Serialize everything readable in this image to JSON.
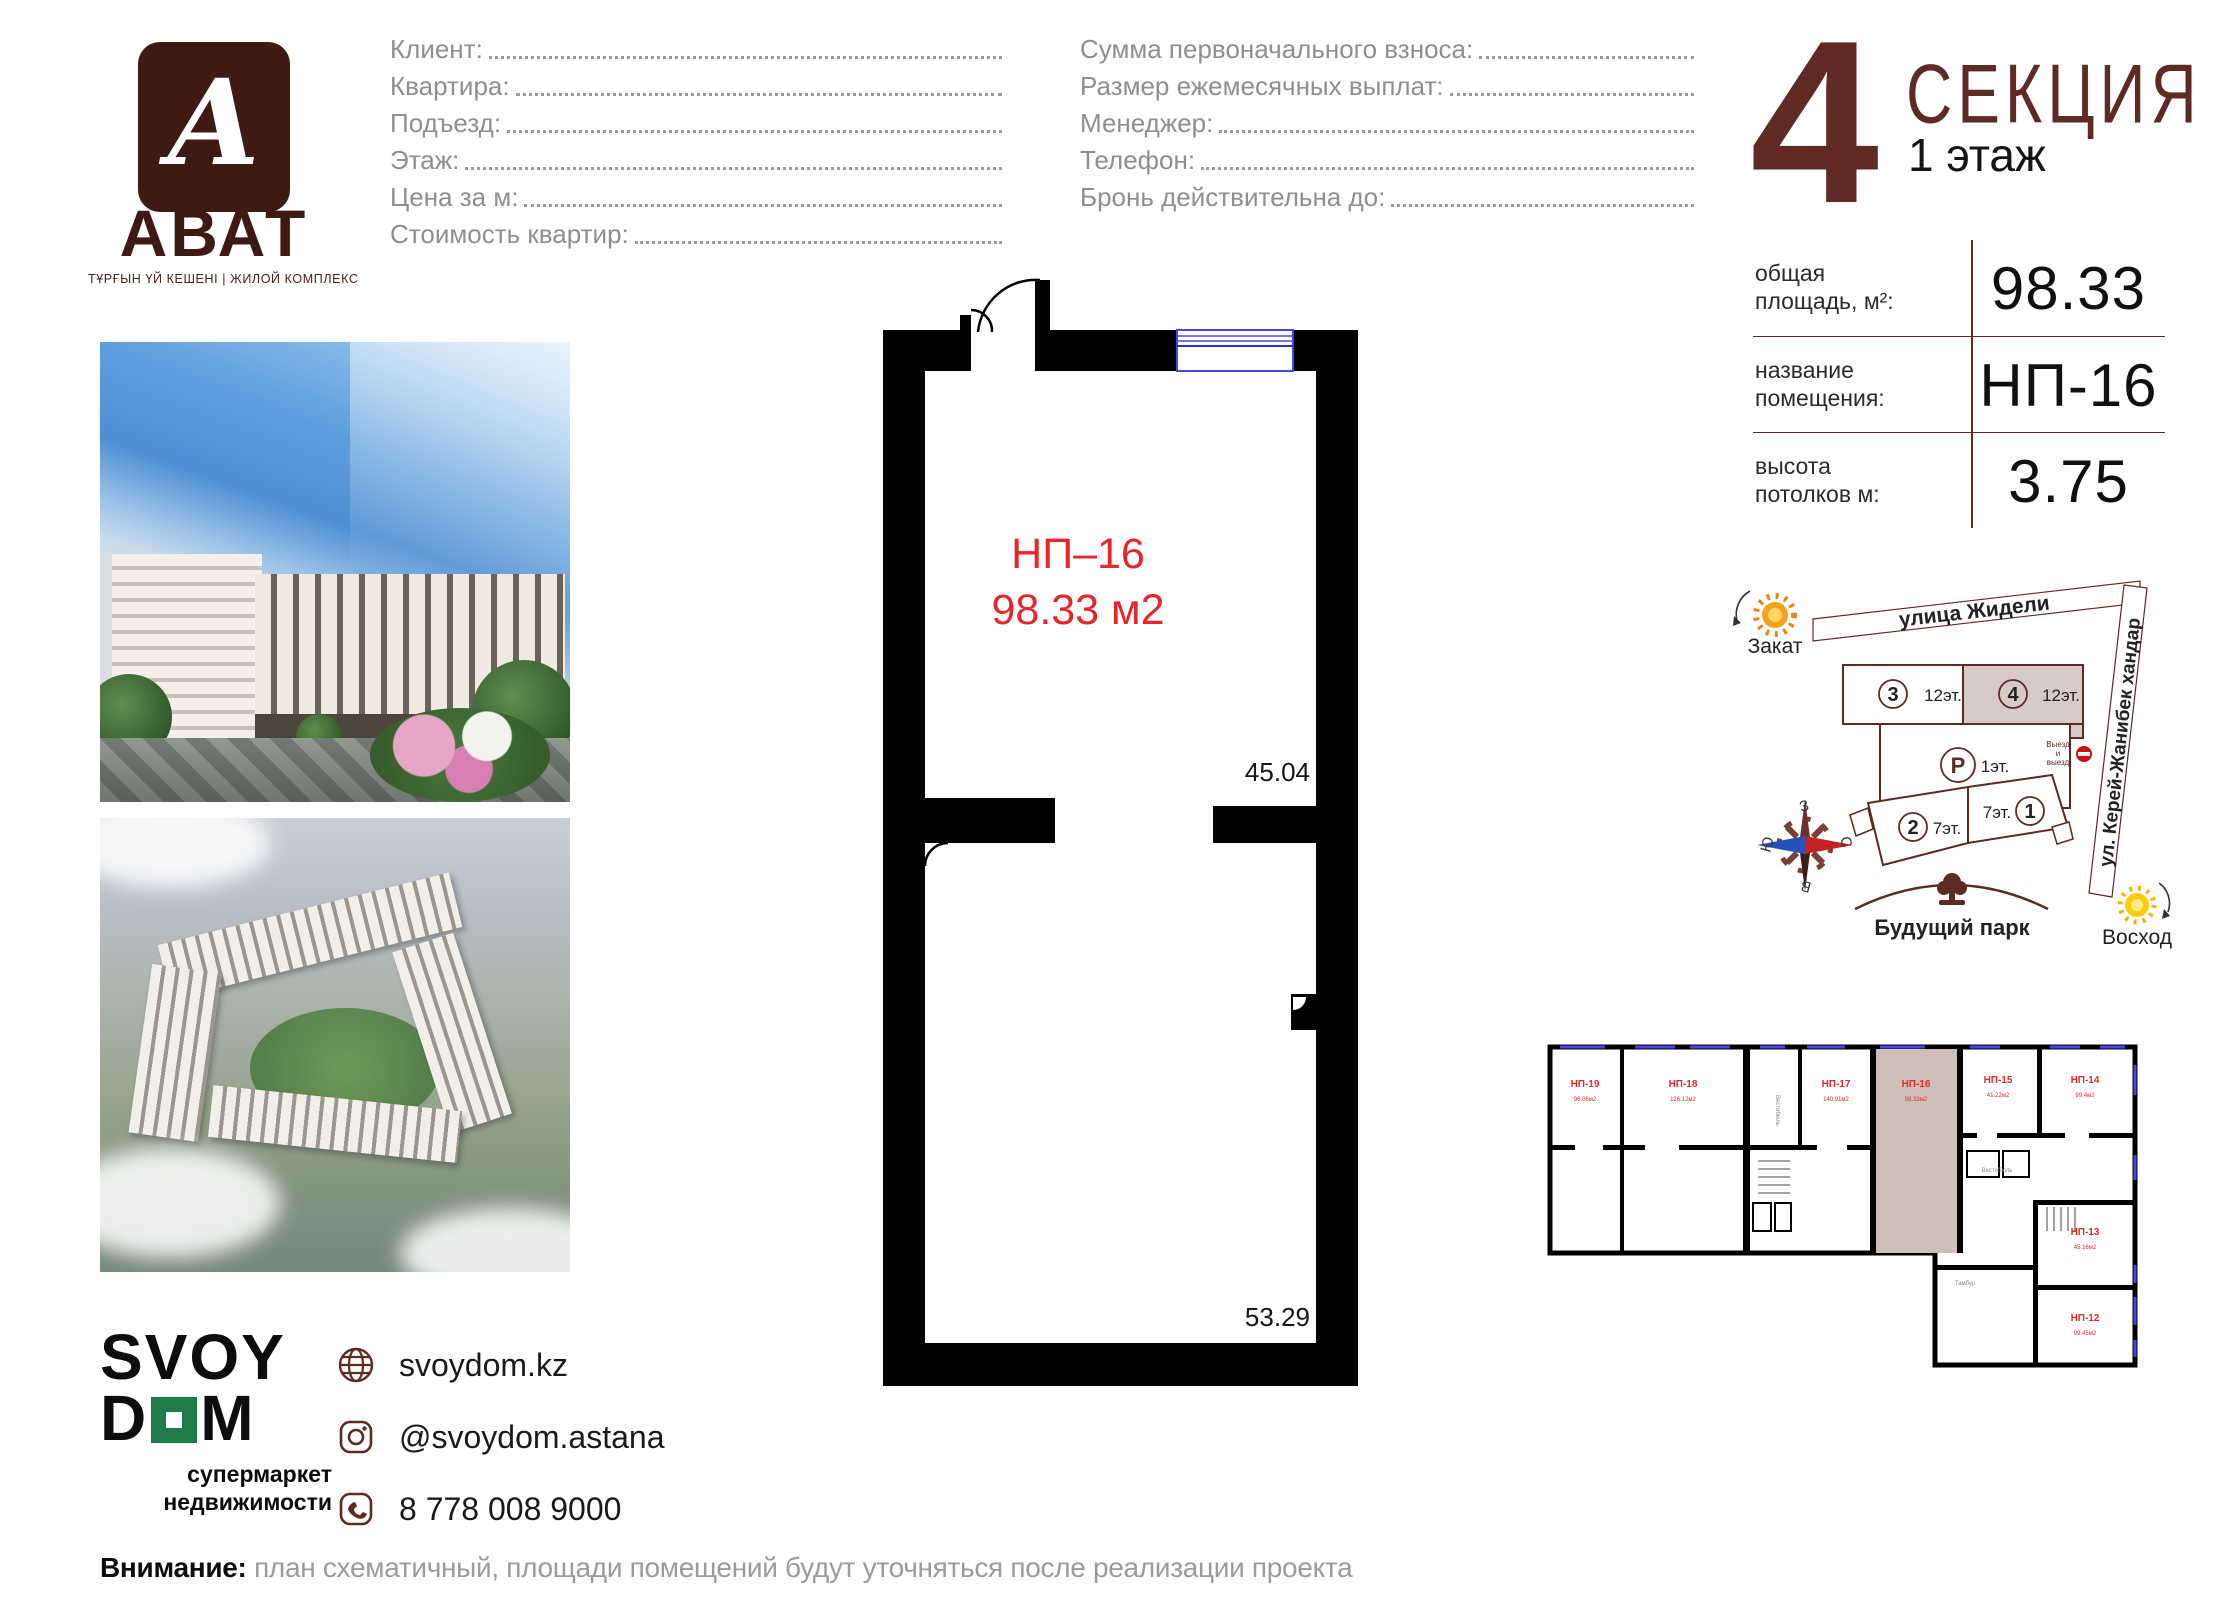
{
  "colors": {
    "maroon": "#5E2A21",
    "dark_maroon": "#3F1A12",
    "red": "#E8262A",
    "green": "#1E7C4B",
    "window_blue": "#4646E6",
    "beige": "#D6C9C4",
    "gray_text": "#8F8F8F"
  },
  "brand": {
    "name": "АВАТ",
    "glyph": "А",
    "tagline": "ТҰРҒЫН ҮЙ КЕШЕНІ | ЖИЛОЙ КОМПЛЕКС"
  },
  "form": {
    "left": [
      "Клиент: ",
      "Квартира: ",
      "Подъезд: ",
      "Этаж: ",
      "Цена за м: ",
      "Стоимость квартир: "
    ],
    "right": [
      "Сумма первоначального взноса: ",
      "Размер ежемесячных выплат: ",
      "Менеджер: ",
      "Телефон: ",
      "Бронь действительна до: "
    ]
  },
  "section": {
    "number": "4",
    "title": "СЕКЦИЯ",
    "floor": "1 этаж"
  },
  "info": {
    "rows": [
      {
        "l1": "общая",
        "l2": "площадь, м²:",
        "value": "98.33"
      },
      {
        "l1": "название",
        "l2": "помещения:",
        "value": "НП-16"
      },
      {
        "l1": "высота",
        "l2": "потолков м:",
        "value": "3.75"
      }
    ]
  },
  "plan": {
    "name": "НП–16",
    "area": "98.33 м2",
    "dim_top": "45.04",
    "dim_bottom": "53.29"
  },
  "map": {
    "street_top": "улица Жидели",
    "street_right": "ул. Керей-Жанибек хандар",
    "sunset": "Закат",
    "sunrise": "Восход",
    "park": "Будущий парк",
    "exit": [
      "Выезд",
      "и",
      "выезд"
    ],
    "sec3": {
      "n": "3",
      "f": "12эт."
    },
    "sec4": {
      "n": "4",
      "f": "12эт."
    },
    "secP": {
      "n": "Р",
      "f": "1эт."
    },
    "sec2": {
      "n": "2",
      "f": "7эт."
    },
    "sec1": {
      "n": "1",
      "f": "7эт."
    },
    "compass": {
      "top": "З",
      "right": "С",
      "bottom": "В",
      "left": "Ю"
    }
  },
  "mini": {
    "units": [
      {
        "name": "НП-19",
        "area": "96.06м2"
      },
      {
        "name": "НП-18",
        "area": "126.12м2"
      },
      {
        "name": "НП-17",
        "area": "140.91м2"
      },
      {
        "name": "НП-16",
        "area": "98.33м2"
      },
      {
        "name": "НП-15",
        "area": "41.22м2"
      },
      {
        "name": "НП-14",
        "area": "99.4м2"
      },
      {
        "name": "НП-13",
        "area": "45.16м2"
      },
      {
        "name": "НП-12",
        "area": "99.45м2"
      }
    ],
    "labels": {
      "vestibule": "Вестибюль",
      "tambour": "Тамбур"
    }
  },
  "footer": {
    "logo1": "SVOY",
    "logo2a": "D",
    "logo2b": "M",
    "tag1": "супермаркет",
    "tag2": "недвижимости",
    "site": "svoydom.kz",
    "instagram": "@svoydom.astana",
    "phone": "8 778 008 9000"
  },
  "note": {
    "bold": "Внимание:",
    "text": " план схематичный, площади помещений будут уточняться после реализации проекта"
  }
}
